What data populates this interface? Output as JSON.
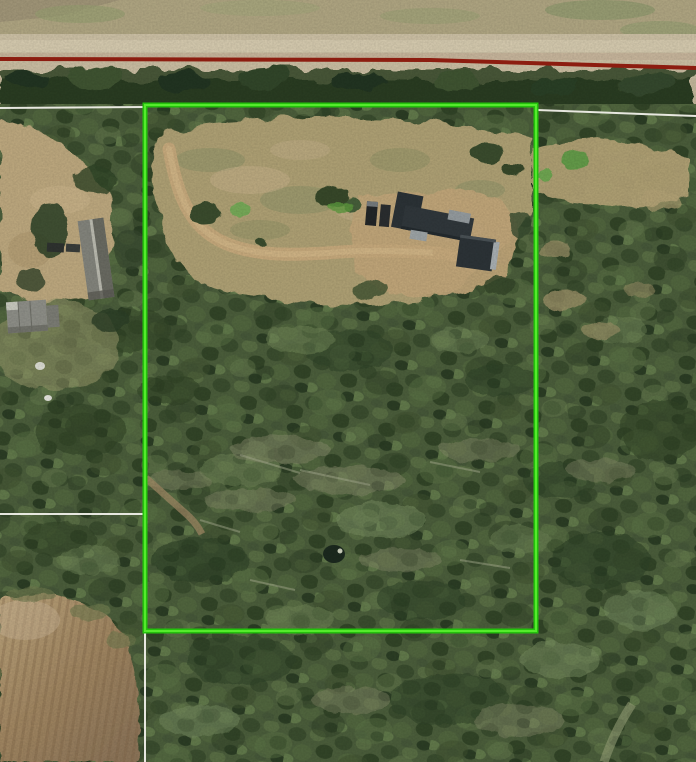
{
  "map": {
    "kind": "aerial-satellite-parcel-view",
    "overlays": {
      "parcel_boundary": {
        "x": 145,
        "y": 105,
        "width": 391,
        "height": 526,
        "color": "#24c10c",
        "highlight_color": "#55ea2d"
      },
      "road_centerline": {
        "color": "#8c1d10",
        "points": "0,59 430,60 696,68"
      },
      "parcel_lines": {
        "color": "#f0efe9",
        "north_west": "0,108 145,107",
        "north_east": "537,110 696,116",
        "west": "0,514 143,514",
        "south": "145,631 145,762"
      }
    },
    "base_colors": {
      "gravel_road": "#cfc3a7",
      "forest": "#4c5f3c",
      "clearing_grass": "#b1a376",
      "plowed_field": "#a38863",
      "building_roof": "#30373b"
    },
    "visible_features": [
      "gravel-road",
      "tree-line",
      "forest",
      "parcel-clearing",
      "driveway-loop",
      "main-house",
      "detached-garage",
      "parked-vehicles",
      "small-pond",
      "neighbor-house",
      "neighbor-shed",
      "plowed-field"
    ]
  }
}
